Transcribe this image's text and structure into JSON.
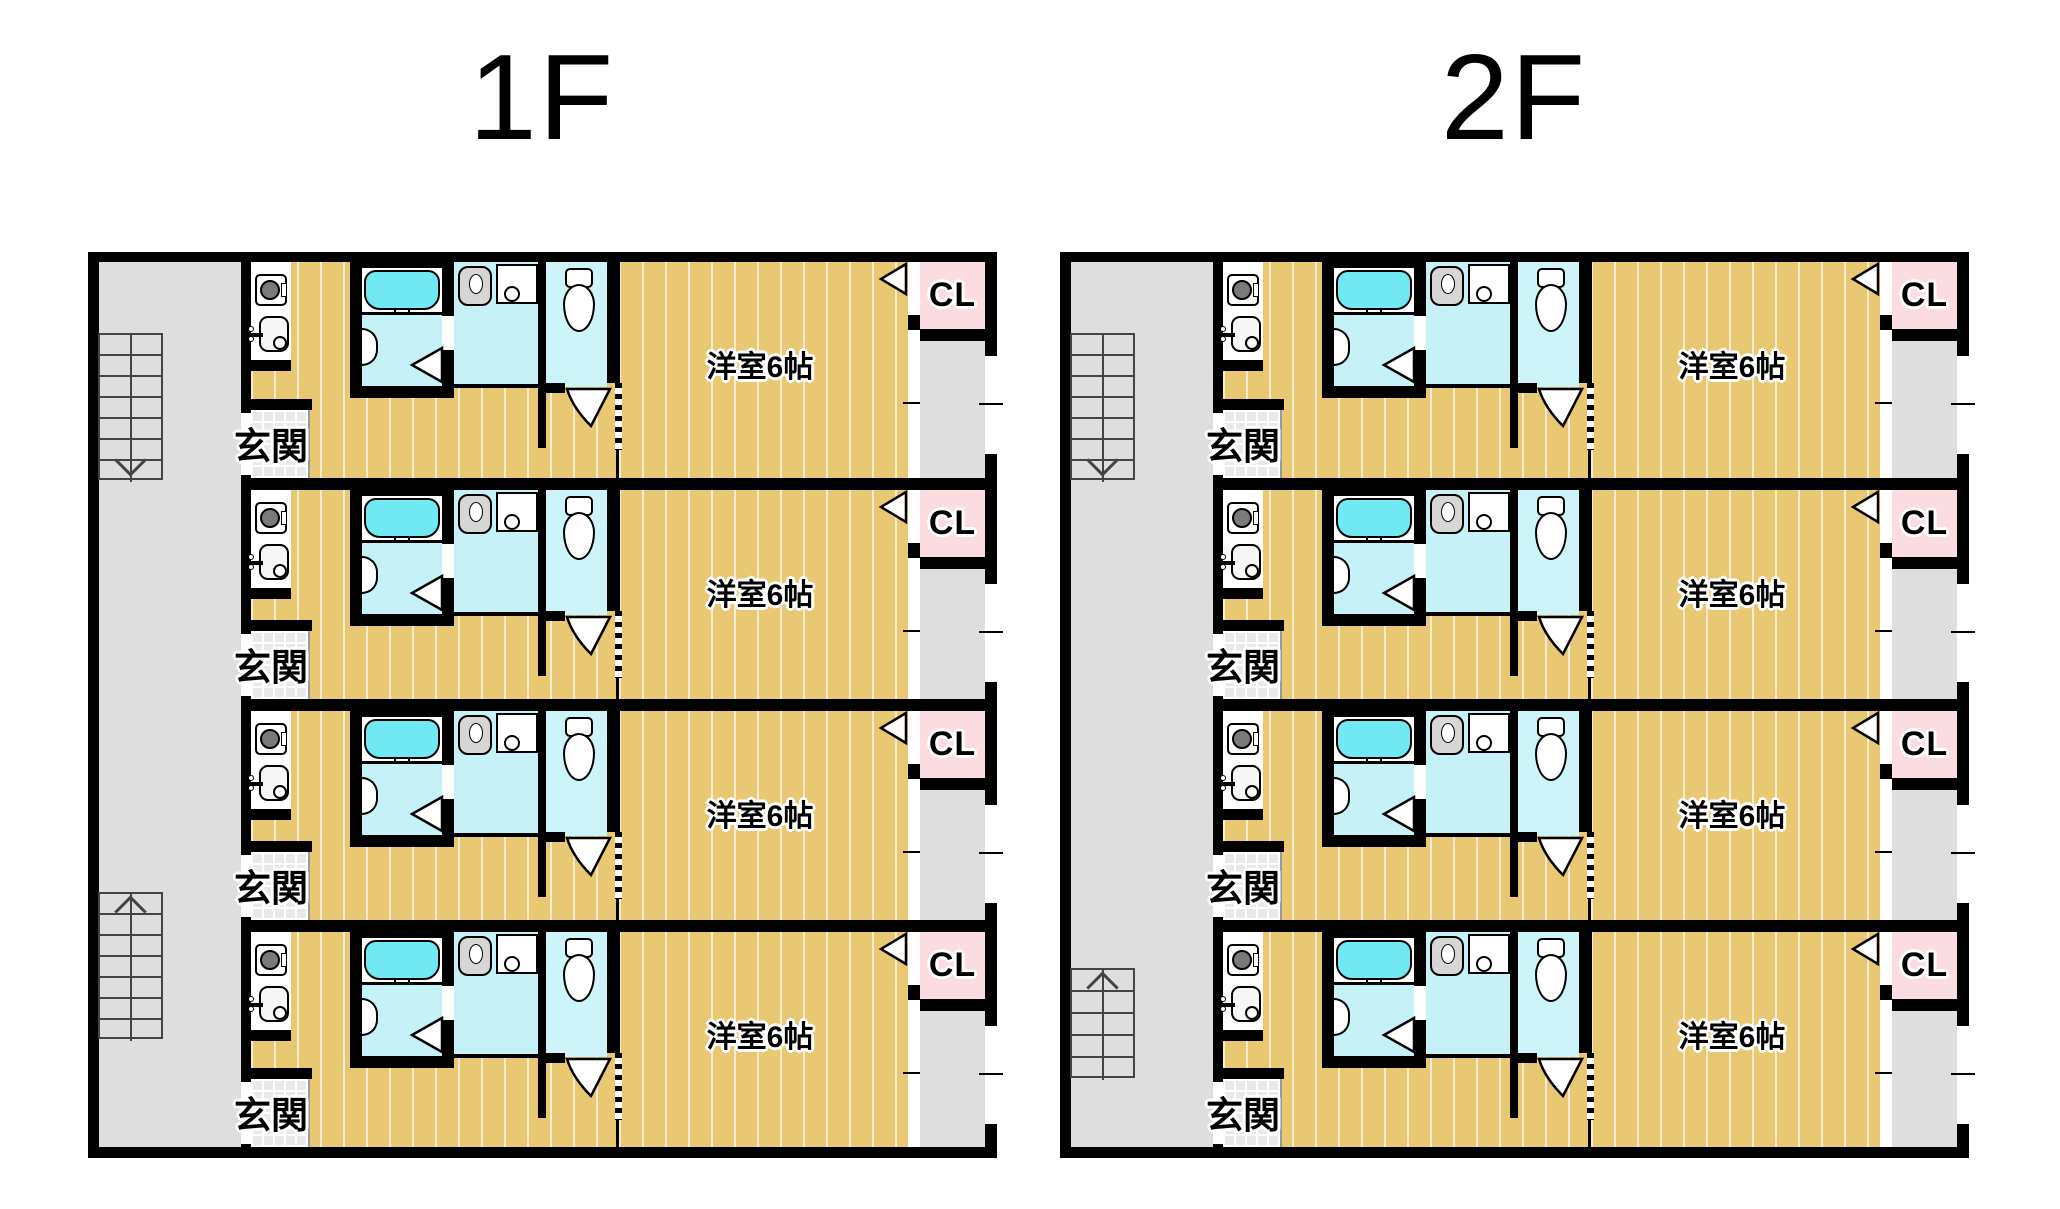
{
  "floors": [
    {
      "title": "1F",
      "stairs": [
        {
          "position": "top",
          "direction": "down",
          "steps": 7
        },
        {
          "position": "bottom",
          "direction": "up",
          "steps": 7
        }
      ],
      "units": [
        {
          "entrance": "玄関",
          "main_room": "洋室6帖",
          "closet": "CL"
        },
        {
          "entrance": "玄関",
          "main_room": "洋室6帖",
          "closet": "CL"
        },
        {
          "entrance": "玄関",
          "main_room": "洋室6帖",
          "closet": "CL"
        },
        {
          "entrance": "玄関",
          "main_room": "洋室6帖",
          "closet": "CL"
        }
      ]
    },
    {
      "title": "2F",
      "stairs": [
        {
          "position": "top",
          "direction": "down",
          "steps": 7
        },
        {
          "position": "bottom",
          "direction": "up",
          "steps": 5
        }
      ],
      "units": [
        {
          "entrance": "玄関",
          "main_room": "洋室6帖",
          "closet": "CL"
        },
        {
          "entrance": "玄関",
          "main_room": "洋室6帖",
          "closet": "CL"
        },
        {
          "entrance": "玄関",
          "main_room": "洋室6帖",
          "closet": "CL"
        },
        {
          "entrance": "玄関",
          "main_room": "洋室6帖",
          "closet": "CL"
        }
      ]
    }
  ],
  "colors": {
    "wall": "#000000",
    "wood_floor": "#e9c873",
    "wet_floor": "#c6f1f6",
    "bathtub": "#70e9f3",
    "closet_pink": "#fbdce0",
    "common_gray": "#dedede",
    "tile_gray": "#e9e9e9",
    "stair_line": "#444444"
  }
}
